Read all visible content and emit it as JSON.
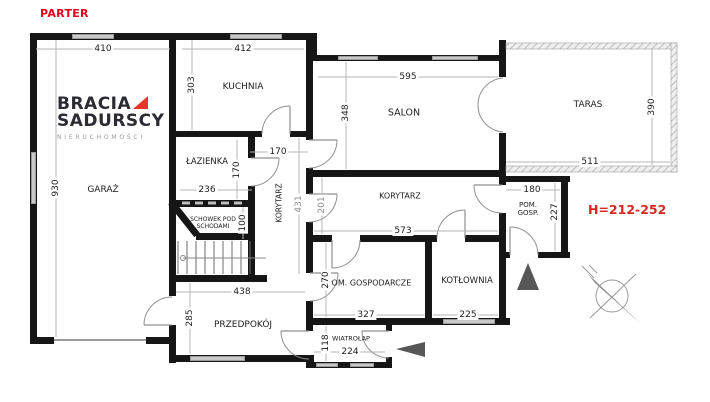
{
  "title": "PARTER",
  "height_note": "H=212-252",
  "logo": {
    "brand_top": "BRACIA",
    "brand_bottom": "SADURSCY",
    "tagline": "NIERUCHOMOŚCI"
  },
  "rooms": {
    "garaz": "GARAŻ",
    "kuchnia": "KUCHNIA",
    "lazienka": "ŁAZIENKA",
    "schowek": "SCHOWEK POD SCHODAMI",
    "korytarz_pion": "KORYTARZ",
    "salon": "SALON",
    "taras": "TARAS",
    "korytarz": "KORYTARZ",
    "pom_gosp": "POM. GOSP.",
    "pom_gospodarcze": "POM. GOSPODARCZE",
    "kotlownia": "KOTŁOWNIA",
    "przedpokoj": "PRZEDPOKÓJ",
    "wiatrolap": "WIATROŁAP"
  },
  "dims": {
    "garaz_szer": "410",
    "garaz_dl": "930",
    "kuchnia_szer": "412",
    "kuchnia_wys": "303",
    "salon_szer": "595",
    "salon_wys": "348",
    "taras_szer": "511",
    "taras_wys": "390",
    "przedsionek_szer": "170",
    "lazienka_wys": "170",
    "lazienka_szer": "236",
    "schowek_wys": "100",
    "korytarz_pion_dl": "431",
    "przejscie_wys": "201",
    "korytarz_dl": "573",
    "pom_gosp_szer": "180",
    "pom_gosp_wys": "227",
    "pom_gospodarcze_wys": "270",
    "pom_gospodarcze_szer": "327",
    "kotlownia_szer": "225",
    "przedpokoj_szer": "438",
    "przedpokoj_wys": "285",
    "wiatrolap_wys": "118",
    "wiatrolap_szer": "224"
  },
  "colors": {
    "accent_red": "#e8001c",
    "logo_red": "#e63329",
    "wall": "#161616",
    "arrow_gray": "#565656"
  }
}
